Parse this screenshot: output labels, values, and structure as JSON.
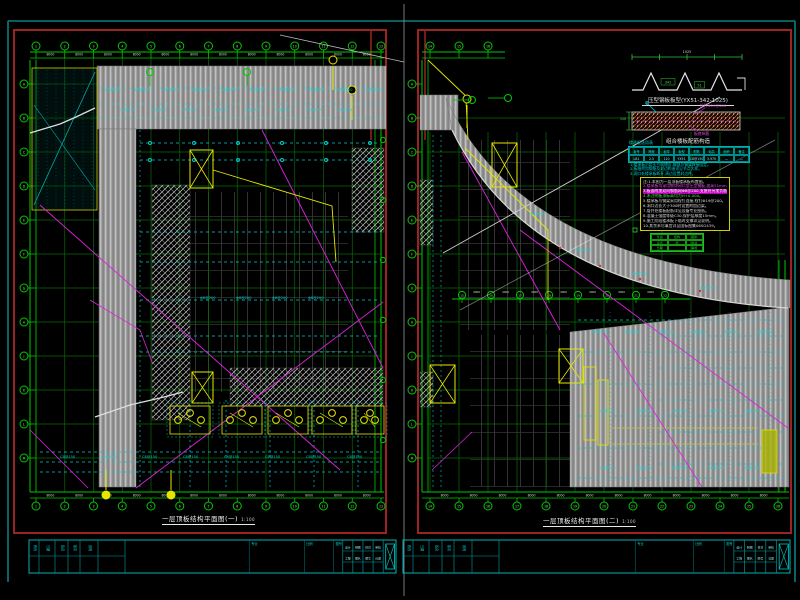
{
  "drawing": {
    "background": "#000000",
    "sheet_left": {
      "title": "一层顶板结构平面图(一)",
      "scale": "1:100"
    },
    "sheet_right": {
      "title": "一层顶板结构平面图(二)",
      "scale": "1:100"
    }
  },
  "colors": {
    "frame_red": "#9b2323",
    "teal_border": "#0d7d7d",
    "divider_gray": "#8a99a0",
    "grid_green_bright": "#00c800",
    "grid_green_dim": "#076b07",
    "cyan": "#00c8c8",
    "magenta": "#dd22dd",
    "yellow": "#e6e600",
    "deck_gray": "#9a9a9a",
    "white_line": "#d8d8d8",
    "note_green": "#2ed42e"
  },
  "axes": {
    "top": [
      "1",
      "2",
      "3",
      "4",
      "5",
      "6",
      "7",
      "8",
      "9",
      "10",
      "11",
      "12",
      "13"
    ],
    "side": [
      "A",
      "B",
      "C",
      "D",
      "E",
      "F",
      "G",
      "H",
      "J",
      "K",
      "L",
      "M"
    ],
    "bottom_right": [
      "14",
      "15",
      "16",
      "17",
      "18",
      "19",
      "20",
      "21",
      "22",
      "23",
      "24",
      "25",
      "26"
    ],
    "mid_right": [
      "15",
      "16",
      "17",
      "18",
      "19",
      "20",
      "21",
      "22"
    ]
  },
  "dims": {
    "typical": "8000",
    "sub": "4000"
  },
  "clutter": {
    "deck_mark": "Φ8@200",
    "slab_mark": "C8@150"
  },
  "details": {
    "profile": {
      "caption": "压型钢板板型(YX51-342-1025)",
      "dim_top": "1025",
      "label_a": "342",
      "label_b": "51"
    },
    "section": {
      "caption": "组合楼板配筋构造",
      "label_top": "栓钉Φ19@200",
      "label_bottom": "板底纵筋",
      "label_left": "110"
    },
    "table": {
      "title": "楼承板选用表",
      "headers": [
        "板号",
        "跨度",
        "板厚",
        "板型",
        "配筋",
        "标高",
        "面积",
        "备注"
      ],
      "row": [
        "LB1",
        "2.5",
        "110",
        "YX51",
        "C8@150",
        "3.970",
        "—",
        "—"
      ]
    },
    "cyan_notes": [
      "1.楼承板沿箭头方向铺设,端部与钢梁焊接固定。",
      "2.板缝附加钢筋及封边构造详见节点大样。",
      "3.洞口处楼承板断开,周边设置封边件。"
    ],
    "notes_lines": [
      {
        "text": "注:1.本图为一层顶板楼承板布置图。",
        "color": "white"
      },
      {
        "text": "2.楼承板均采用镀锌闭口型压型钢板,波高51mm。",
        "color": "magenta"
      },
      {
        "text": "3.板面附加双向钢筋网Φ8@200,支座处另加负筋。",
        "color": "highlight"
      },
      {
        "text": "4.未注明板顶标高均为H+0.000。",
        "color": "green"
      },
      {
        "text": "5.楼承板与钢梁采用栓钉连接,栓钉Φ19@200。",
        "color": "white"
      },
      {
        "text": "6.洞口边长大于300时设置附加边梁。",
        "color": "white"
      },
      {
        "text": "7.管井处楼板配筋详见设备专业图纸。",
        "color": "white"
      },
      {
        "text": "8.混凝土强度等级C30,保护层厚度15mm。",
        "color": "white"
      },
      {
        "text": "9.施工阶段楼承板下临时支撑详见说明。",
        "color": "white"
      },
      {
        "text": "10.其余未尽事宜详见国标图集06SG439。",
        "color": "white"
      }
    ],
    "stamp_cells": [
      "专业",
      "结构",
      "图别",
      "设计",
      "施",
      "校对",
      "日期",
      "",
      "审核"
    ]
  },
  "titleblock": {
    "left_columns": [
      "修改",
      "日期",
      "签名",
      "版次",
      "说明"
    ],
    "mid_ticks": [
      "专业",
      "比例",
      "图号"
    ],
    "right_grid": [
      "设计",
      "制图",
      "校对",
      "审核",
      "工程",
      "图名",
      "图号",
      "日期"
    ]
  }
}
